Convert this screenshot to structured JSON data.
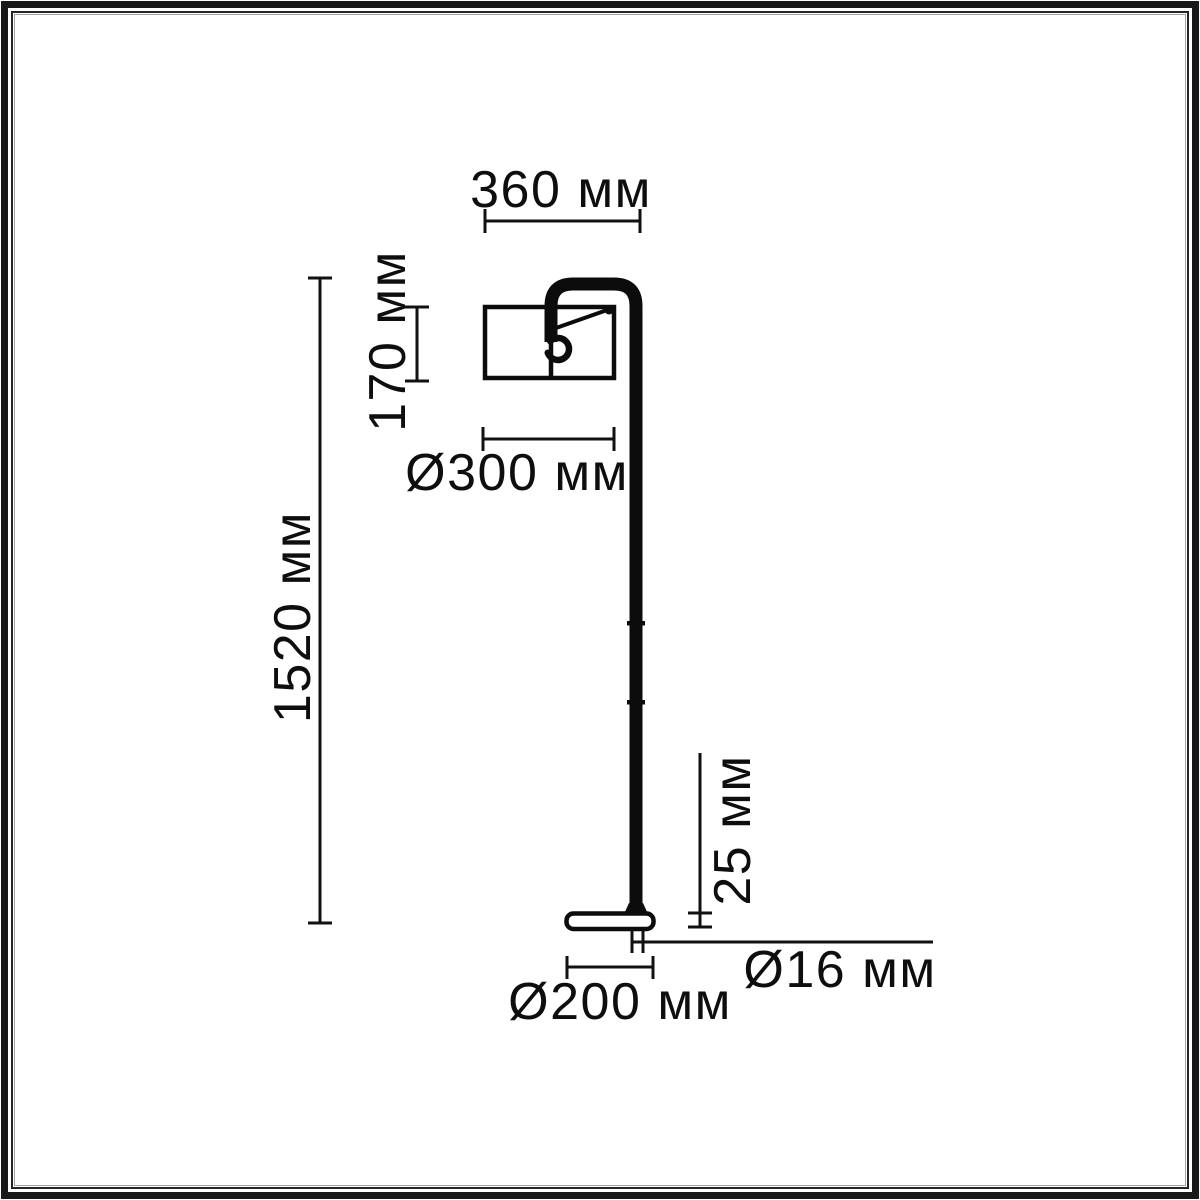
{
  "drawing_labels": {
    "top_width": "360 мм",
    "shade_height": "170 мм",
    "shade_diameter": "Ø300 мм",
    "total_height": "1520 мм",
    "base_height": "25 мм",
    "pole_diameter": "Ø16 мм",
    "base_diameter": "Ø200 мм"
  },
  "colors": {
    "ink": "#0c0c0c",
    "dimension_line": "#111111",
    "background": "#ffffff",
    "frame_outer": "#181818",
    "frame_inner_line": "#262626",
    "frame_accent_line": "#a5a5a5"
  }
}
